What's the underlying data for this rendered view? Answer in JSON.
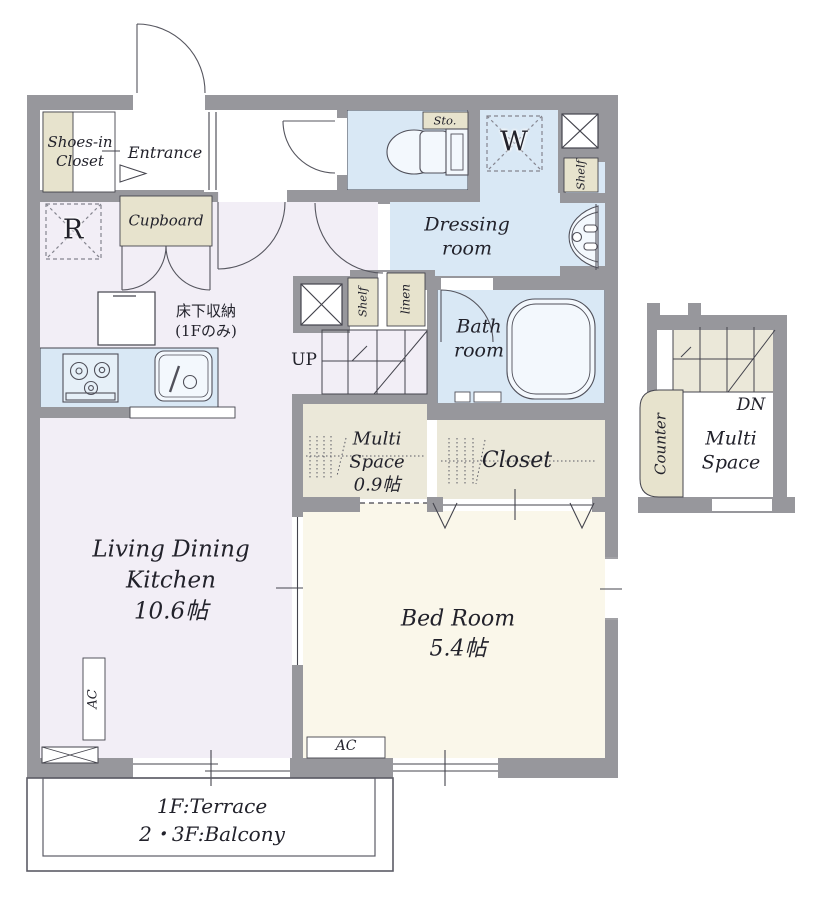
{
  "colors": {
    "wall": "#97979c",
    "line": "#44444d",
    "text": "#22222b",
    "wet": "#d9e8f5",
    "ldk": "#f2eef6",
    "cream": "#faf7ea",
    "beige": "#ebe8d9",
    "label_beige": "#e7e3cd",
    "fixture": "#f3f8fd",
    "terrace_line": "#5c5c66"
  },
  "labels": {
    "shoes_closet": "Shoes-in\nCloset",
    "entrance": "Entrance",
    "refrigerator": "R",
    "cupboard": "Cupboard",
    "sto": "Sto.",
    "washer": "W",
    "shelf_top": "Shelf",
    "dressing_room": "Dressing\nroom",
    "shelf_mid": "Shelf",
    "linen": "linen",
    "up": "UP",
    "bath_room": "Bath\nroom",
    "multi_space_small": "Multi\nSpace\n0.9帖",
    "closet": "Closet",
    "underfloor_storage": "床下収納\n(1Fのみ)",
    "ldk": "Living Dining\nKitchen\n10.6帖",
    "bedroom": "Bed Room\n5.4帖",
    "ac_ldk": "AC",
    "ac_bedroom": "AC",
    "dn": "DN",
    "multi_space_annex": "Multi\nSpace",
    "counter": "Counter",
    "terrace": "1F:Terrace\n2・3F:Balcony"
  }
}
